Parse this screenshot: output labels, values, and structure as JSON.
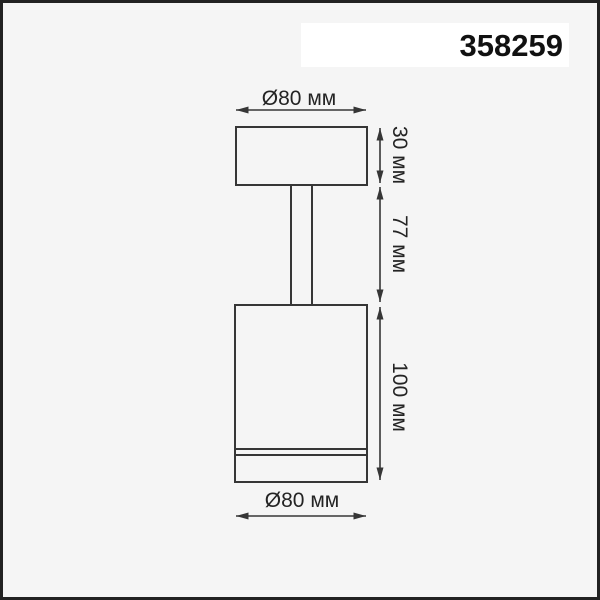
{
  "product_label": {
    "code": "358259"
  },
  "diagram": {
    "labels": {
      "top_diameter": "Ø80 мм",
      "height_top": "30 мм",
      "height_stem": "77 мм",
      "height_body": "100 мм",
      "bottom_diameter": "Ø80 мм"
    },
    "dimensions_mm": {
      "diameter": 80,
      "canopy_height": 30,
      "stem_height": 77,
      "body_height": 100
    }
  },
  "colors": {
    "page_bg": "#f5f5f5",
    "frame": "#222222",
    "line": "#363636",
    "text": "#242424",
    "label_bg": "#ffffff"
  }
}
